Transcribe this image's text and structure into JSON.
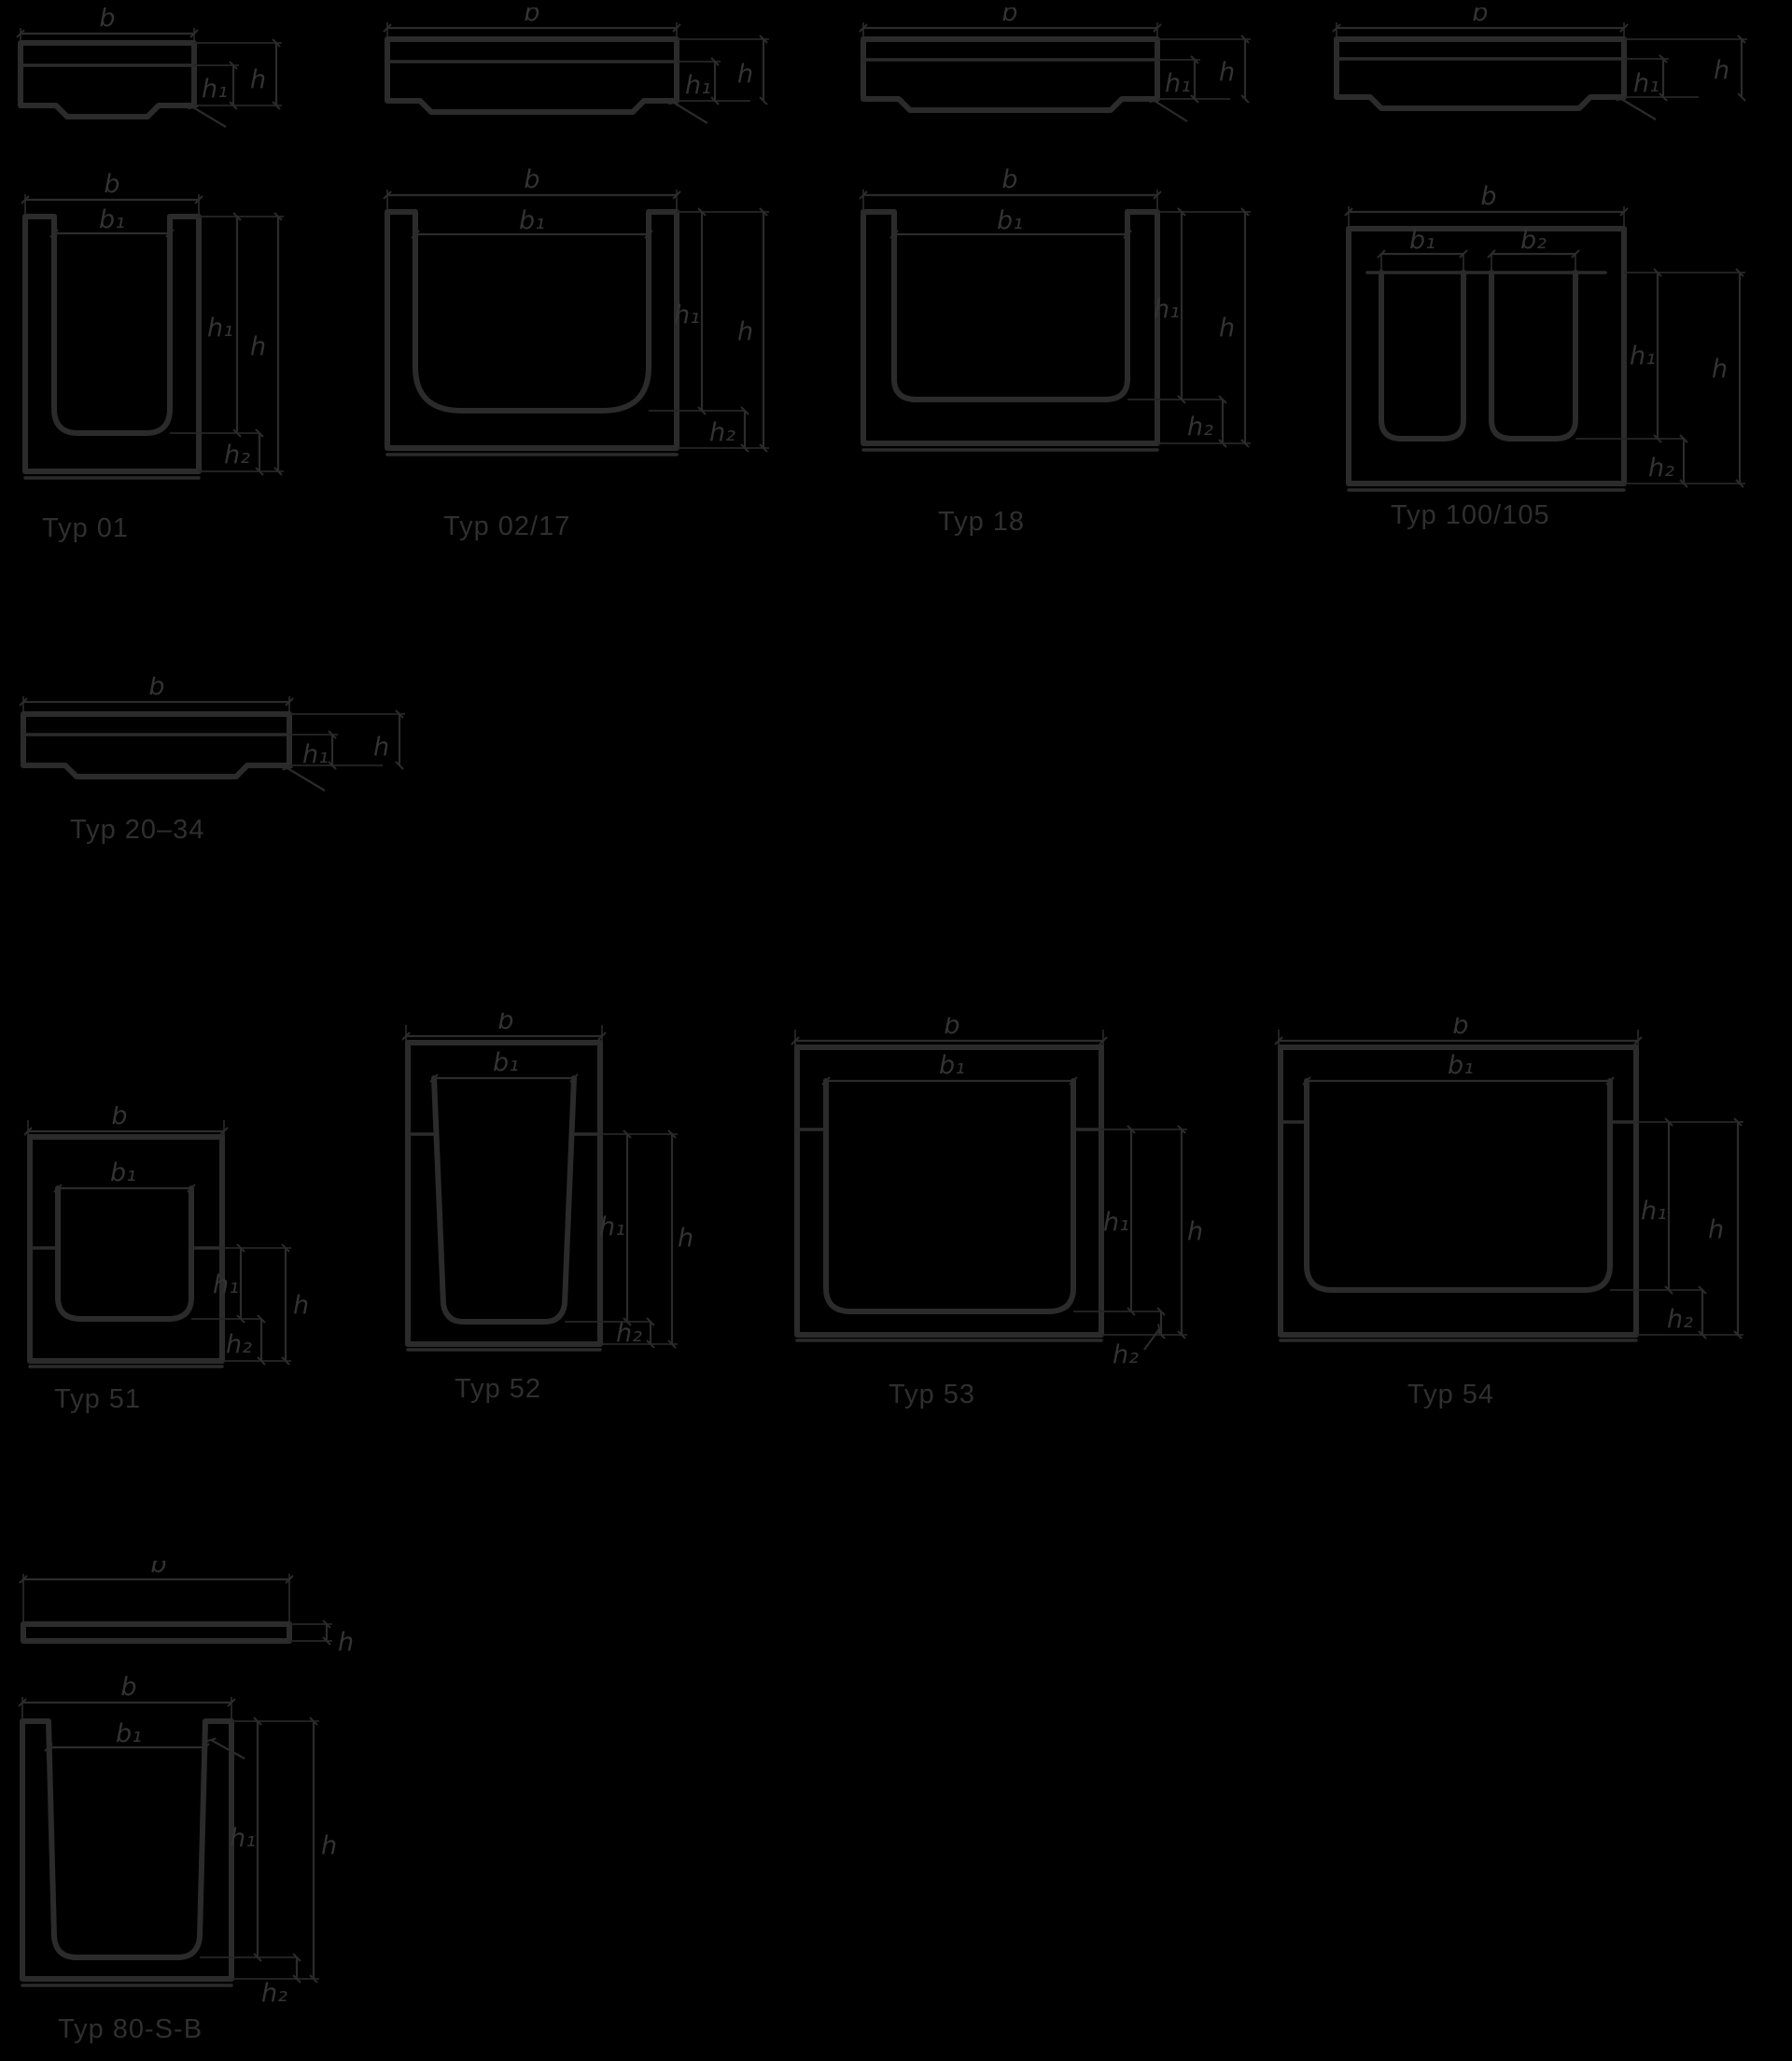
{
  "page": {
    "background": "#000000",
    "line_color": "#2b2b2b",
    "label_color": "#333333",
    "caption_color": "#2f2f2f",
    "content": "Cross-section dimension drawings of channel profile types"
  },
  "diagrams": [
    {
      "id": "typ-01",
      "caption": "Typ 01",
      "cover": {
        "b": "b",
        "h": "h",
        "h1": "h₁"
      },
      "channel": {
        "b": "b",
        "b1": "b₁",
        "h": "h",
        "h1": "h₁",
        "h2": "h₂"
      }
    },
    {
      "id": "typ-02-17",
      "caption": "Typ 02/17",
      "cover": {
        "b": "b",
        "h": "h",
        "h1": "h₁"
      },
      "channel": {
        "b": "b",
        "b1": "b₁",
        "h": "h",
        "h1": "h₁",
        "h2": "h₂"
      }
    },
    {
      "id": "typ-18",
      "caption": "Typ 18",
      "cover": {
        "b": "b",
        "h": "h",
        "h1": "h₁"
      },
      "channel": {
        "b": "b",
        "b1": "b₁",
        "h": "h",
        "h1": "h₁",
        "h2": "h₂"
      }
    },
    {
      "id": "typ-100-105",
      "caption": "Typ 100/105",
      "cover": {
        "b": "b",
        "h": "h",
        "h1": "h₁"
      },
      "channel": {
        "b": "b",
        "b1": "b₁",
        "b2": "b₂",
        "h": "h",
        "h1": "h₁",
        "h2": "h₂"
      }
    },
    {
      "id": "typ-20-34",
      "caption": "Typ 20–34",
      "cover": {
        "b": "b",
        "h": "h",
        "h1": "h₁"
      }
    },
    {
      "id": "typ-51",
      "caption": "Typ 51",
      "channel": {
        "b": "b",
        "b1": "b₁",
        "h": "h",
        "h1": "h₁",
        "h2": "h₂"
      }
    },
    {
      "id": "typ-52",
      "caption": "Typ 52",
      "channel": {
        "b": "b",
        "b1": "b₁",
        "h": "h",
        "h1": "h₁",
        "h2": "h₂"
      }
    },
    {
      "id": "typ-53",
      "caption": "Typ 53",
      "channel": {
        "b": "b",
        "b1": "b₁",
        "h": "h",
        "h1": "h₁",
        "h2": "h₂"
      }
    },
    {
      "id": "typ-54",
      "caption": "Typ 54",
      "channel": {
        "b": "b",
        "b1": "b₁",
        "h": "h",
        "h1": "h₁",
        "h2": "h₂"
      }
    },
    {
      "id": "typ-80-s-b",
      "caption": "Typ 80-S-B",
      "strip": {
        "b": "b",
        "h": "h"
      },
      "channel": {
        "b": "b",
        "b1": "b₁",
        "h": "h",
        "h1": "h₁",
        "h2": "h₂"
      }
    }
  ]
}
